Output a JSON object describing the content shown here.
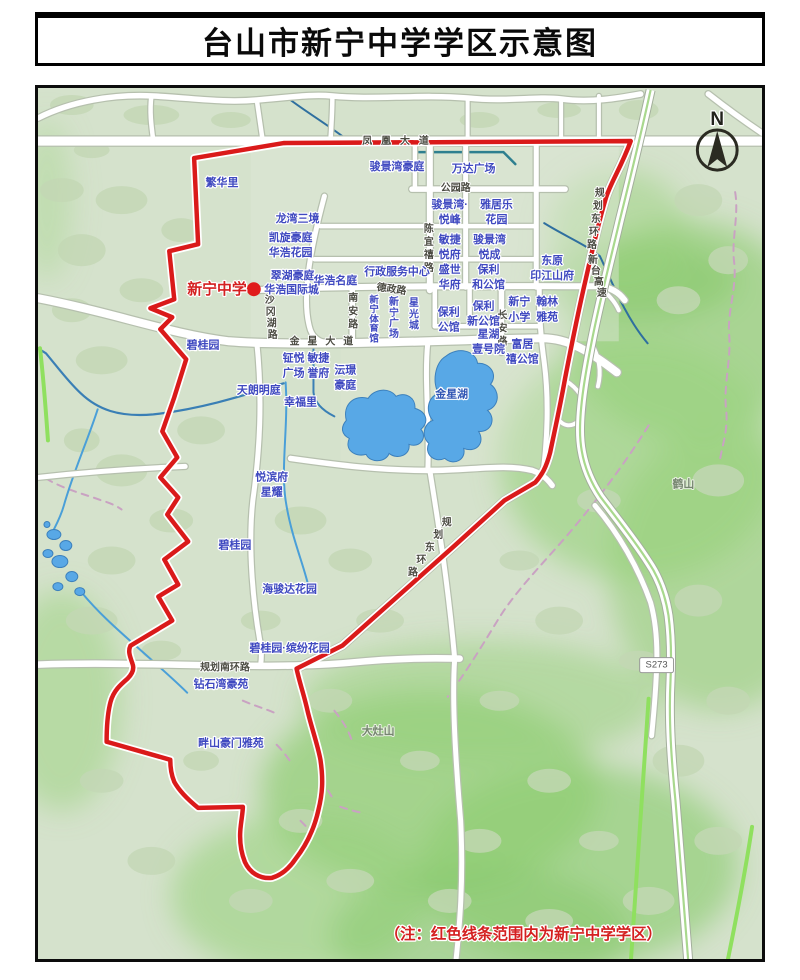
{
  "title": "台山市新宁中学学区示意图",
  "note": "（注：红色线条范围内为新宁中学学区）",
  "compass": {
    "label": "N"
  },
  "school_marker": {
    "label": "新宁中学"
  },
  "colors": {
    "boundary_red": "#da1a1a",
    "estate_label_blue": "#3f49c0",
    "road_label_gray": "#4b4b42",
    "water_blue": "#58a8e6",
    "terrain_green": "#d5e2cc",
    "hill_green": "#96cf7a",
    "note_red": "#d42020"
  },
  "map": {
    "labels": [
      {
        "t": "凤凰大道",
        "x": 400,
        "y": 144,
        "cls": "road",
        "ls": 9
      },
      {
        "t": "公园路",
        "x": 456,
        "y": 191,
        "cls": "road"
      },
      {
        "t": "德政路",
        "x": 391,
        "y": 292,
        "cls": "road",
        "rot": 8
      },
      {
        "t": "金星大道",
        "x": 325,
        "y": 344,
        "cls": "road",
        "ls": 8
      },
      {
        "t": "规划南环路",
        "x": 224,
        "y": 670,
        "cls": "road"
      },
      {
        "t": "陈宜禧路",
        "x": 429,
        "y": 232,
        "cls": "road",
        "vert": {
          "step": 13
        }
      },
      {
        "t": "南安路",
        "x": 353,
        "y": 301,
        "cls": "road",
        "vert": {
          "step": 13
        }
      },
      {
        "t": "长安路",
        "x": 503,
        "y": 318,
        "cls": "road",
        "vert": {
          "step": 13
        }
      },
      {
        "t": "沙冈湖路",
        "x": 269,
        "y": 303,
        "cls": "road",
        "vert": {
          "step": 11.5,
          "dx": 1
        }
      },
      {
        "t": "规划东环路",
        "x": 601,
        "y": 196,
        "cls": "road",
        "vert": {
          "step": 13,
          "dx": -2
        }
      },
      {
        "t": "新台高速",
        "x": 594,
        "y": 263,
        "cls": "road",
        "vert": {
          "step": 11,
          "dx": 3
        }
      },
      {
        "t": "规划东环路",
        "x": 447,
        "y": 525,
        "cls": "road",
        "vert": {
          "step": 12.5,
          "dx": -8.5
        }
      },
      {
        "t": "S273",
        "x": 658,
        "y": 667,
        "cls": "shield",
        "name": "s273-shield-label"
      },
      {
        "t": "繁华里",
        "x": 221,
        "y": 186
      },
      {
        "t": "骏景湾豪庭",
        "x": 397,
        "y": 170
      },
      {
        "t": "万达广场",
        "x": 474,
        "y": 172
      },
      {
        "t": "龙湾三境",
        "x": 297,
        "y": 222
      },
      {
        "t": "凯旋豪庭",
        "x": 290,
        "y": 241
      },
      {
        "t": "华浩花园",
        "x": 290,
        "y": 256
      },
      {
        "lines": [
          "骏景湾·",
          "悦峰"
        ],
        "x": 450,
        "y": 208
      },
      {
        "lines": [
          "雅居乐",
          "花园"
        ],
        "x": 497,
        "y": 208
      },
      {
        "lines": [
          "敏捷",
          "悦府"
        ],
        "x": 450,
        "y": 243
      },
      {
        "lines": [
          "骏景湾",
          "悦成"
        ],
        "x": 490,
        "y": 243
      },
      {
        "lines": [
          "盛世",
          "华府"
        ],
        "x": 450,
        "y": 273
      },
      {
        "lines": [
          "保利",
          "和公馆"
        ],
        "x": 489,
        "y": 273
      },
      {
        "lines": [
          "东原",
          "印江山府"
        ],
        "x": 553,
        "y": 264
      },
      {
        "t": "翠湖豪庭",
        "x": 292,
        "y": 279
      },
      {
        "t": "华浩国际城",
        "x": 291,
        "y": 293
      },
      {
        "t": "华浩名庭",
        "x": 335,
        "y": 284
      },
      {
        "t": "行政服务中心",
        "x": 397,
        "y": 275
      },
      {
        "t": "新宁体育馆",
        "x": 374,
        "y": 303,
        "size": 9.5,
        "vert": {
          "step": 9.5
        }
      },
      {
        "t": "新宁广场",
        "x": 394,
        "y": 305,
        "size": 10,
        "vert": {
          "step": 10.5
        }
      },
      {
        "t": "星光城",
        "x": 414,
        "y": 306,
        "size": 10,
        "vert": {
          "step": 11
        }
      },
      {
        "lines": [
          "保利",
          "公馆"
        ],
        "x": 449,
        "y": 315
      },
      {
        "lines": [
          "保利",
          "新公馆"
        ],
        "x": 484,
        "y": 309
      },
      {
        "lines": [
          "新宁",
          "小学"
        ],
        "x": 520,
        "y": 305
      },
      {
        "lines": [
          "翰林",
          "雅苑"
        ],
        "x": 548,
        "y": 305
      },
      {
        "lines": [
          "星湖",
          "壹号院"
        ],
        "x": 489,
        "y": 337
      },
      {
        "lines": [
          "富居",
          "禧公馆"
        ],
        "x": 523,
        "y": 347
      },
      {
        "lines": [
          "钲悦",
          "广场"
        ],
        "x": 293,
        "y": 361
      },
      {
        "lines": [
          "敏捷",
          "誉府"
        ],
        "x": 318,
        "y": 361
      },
      {
        "lines": [
          "沄璟",
          "豪庭"
        ],
        "x": 345,
        "y": 373
      },
      {
        "t": "幸福里",
        "x": 300,
        "y": 405
      },
      {
        "t": "天朗明庭",
        "x": 258,
        "y": 393
      },
      {
        "t": "碧桂园",
        "x": 202,
        "y": 348
      },
      {
        "lines": [
          "悦滨府",
          "星耀"
        ],
        "x": 271,
        "y": 480
      },
      {
        "t": "碧桂园",
        "x": 234,
        "y": 548
      },
      {
        "t": "海骏达花园",
        "x": 289,
        "y": 592
      },
      {
        "t": "碧桂园·缤纷花园",
        "x": 289,
        "y": 651
      },
      {
        "t": "钻石湾豪苑",
        "x": 220,
        "y": 687
      },
      {
        "t": "畔山豪门雅苑",
        "x": 230,
        "y": 746
      },
      {
        "t": "金星湖",
        "x": 452,
        "y": 397,
        "cls": "water",
        "name": "lake-label"
      },
      {
        "t": "大灶山",
        "x": 378,
        "y": 734,
        "cls": "mount",
        "name": "mountain-label"
      },
      {
        "t": "鹤山",
        "x": 685,
        "y": 487,
        "cls": "mount",
        "name": "mountain-label"
      },
      {
        "t": "新宁中学",
        "x": 216,
        "y": 294,
        "cls": "red",
        "name": "school-label"
      },
      {
        "t": "N",
        "x": 719,
        "y": 125,
        "cls": "compass",
        "name": "compass-n-label"
      },
      {
        "t": "（注：红色线条范围内为新宁中学学区）",
        "x": 524,
        "y": 938,
        "cls": "note",
        "name": "district-note"
      }
    ]
  }
}
